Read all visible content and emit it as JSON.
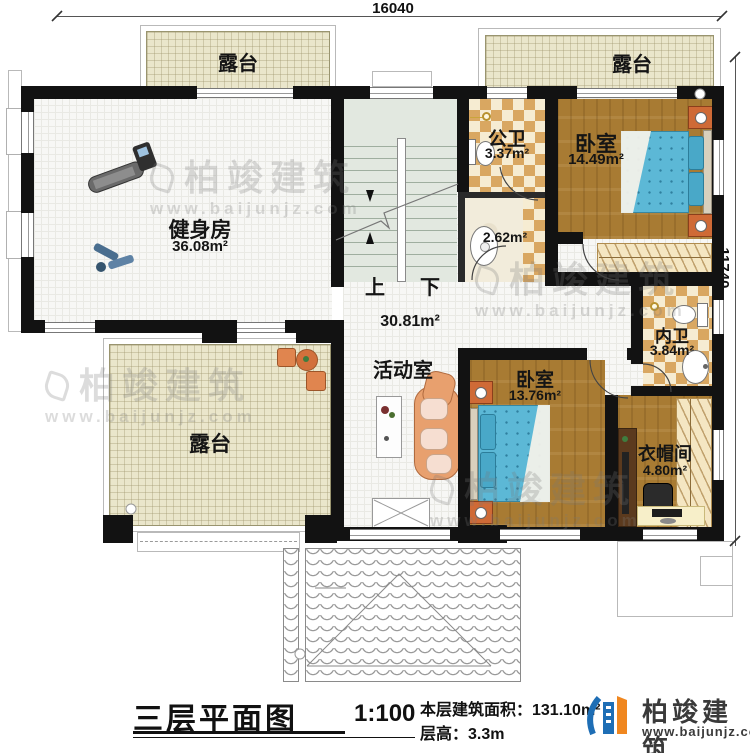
{
  "dimensions": {
    "top": "16040",
    "right": "11740"
  },
  "rooms": {
    "terrace_tl": {
      "label": "露台"
    },
    "terrace_tr": {
      "label": "露台"
    },
    "terrace_b": {
      "label": "露台"
    },
    "gym": {
      "label": "健身房",
      "area": "36.08m²"
    },
    "public_bath": {
      "label": "公卫",
      "area": "3.37m²"
    },
    "shower": {
      "area": "2.62m²"
    },
    "bedroom1": {
      "label": "卧室",
      "area": "14.49m²"
    },
    "activity": {
      "label": "活动室",
      "area": "30.81m²"
    },
    "inner_bath": {
      "label": "内卫",
      "area": "3.84m²"
    },
    "bedroom2": {
      "label": "卧室",
      "area": "13.76m²"
    },
    "cloakroom": {
      "label": "衣帽间",
      "area": "4.80m²"
    }
  },
  "stairs": {
    "up": "上",
    "down": "下"
  },
  "footer": {
    "title": "三层平面图",
    "scale": "1:100",
    "area_line": "本层建筑面积：131.10m²",
    "height_line": "层高：3.3m"
  },
  "brand": {
    "name": "柏竣建筑",
    "site": "www.baijunjz.com"
  },
  "watermark": {
    "name": "柏竣建筑",
    "site": "www.baijunjz.com"
  },
  "colors": {
    "wall": "#121212",
    "terrace_floor": "#eae6cb",
    "wood_floor": "#a87b33",
    "checker_tile": "#d9a761",
    "bed_blue": "#5cb8d6",
    "stair_floor": "#e2e8e0",
    "brand_blue": "#1e6eb5",
    "brand_orange": "#f0871f"
  }
}
